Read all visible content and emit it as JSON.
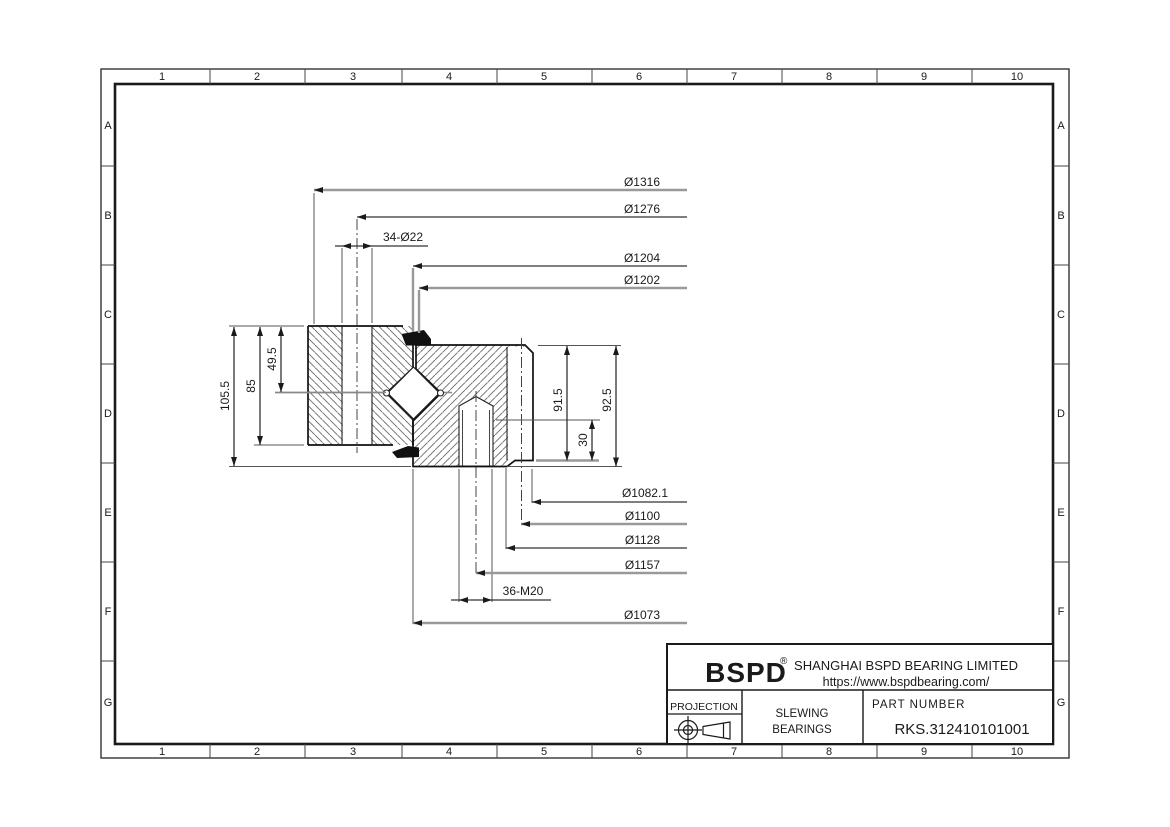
{
  "sheet": {
    "grid": {
      "cols": [
        "1",
        "2",
        "3",
        "4",
        "5",
        "6",
        "7",
        "8",
        "9",
        "10"
      ],
      "rows": [
        "A",
        "B",
        "C",
        "D",
        "E",
        "F",
        "G"
      ]
    }
  },
  "dims": {
    "top": [
      "Ø1316",
      "Ø1276",
      "34-Ø22",
      "Ø1204",
      "Ø1202"
    ],
    "left": [
      "105.5",
      "85",
      "49.5"
    ],
    "right": [
      "91.5",
      "30",
      "92.5"
    ],
    "bottom": [
      "Ø1082.1",
      "Ø1100",
      "Ø1128",
      "Ø1157",
      "36-M20",
      "Ø1073"
    ]
  },
  "title_block": {
    "logo": "BSPD",
    "logo_mark": "®",
    "company": "SHANGHAI BSPD BEARING LIMITED",
    "website": "https://www.bspdbearing.com/",
    "projection_label": "PROJECTION",
    "product_line_1": "SLEWING",
    "product_line_2": "BEARINGS",
    "part_number_label": "PART  NUMBER",
    "part_number": "RKS.312410101001"
  },
  "colors": {
    "line": "#1a1a1a",
    "gray_line": "#999999",
    "hatch": "#6a6a6a"
  }
}
